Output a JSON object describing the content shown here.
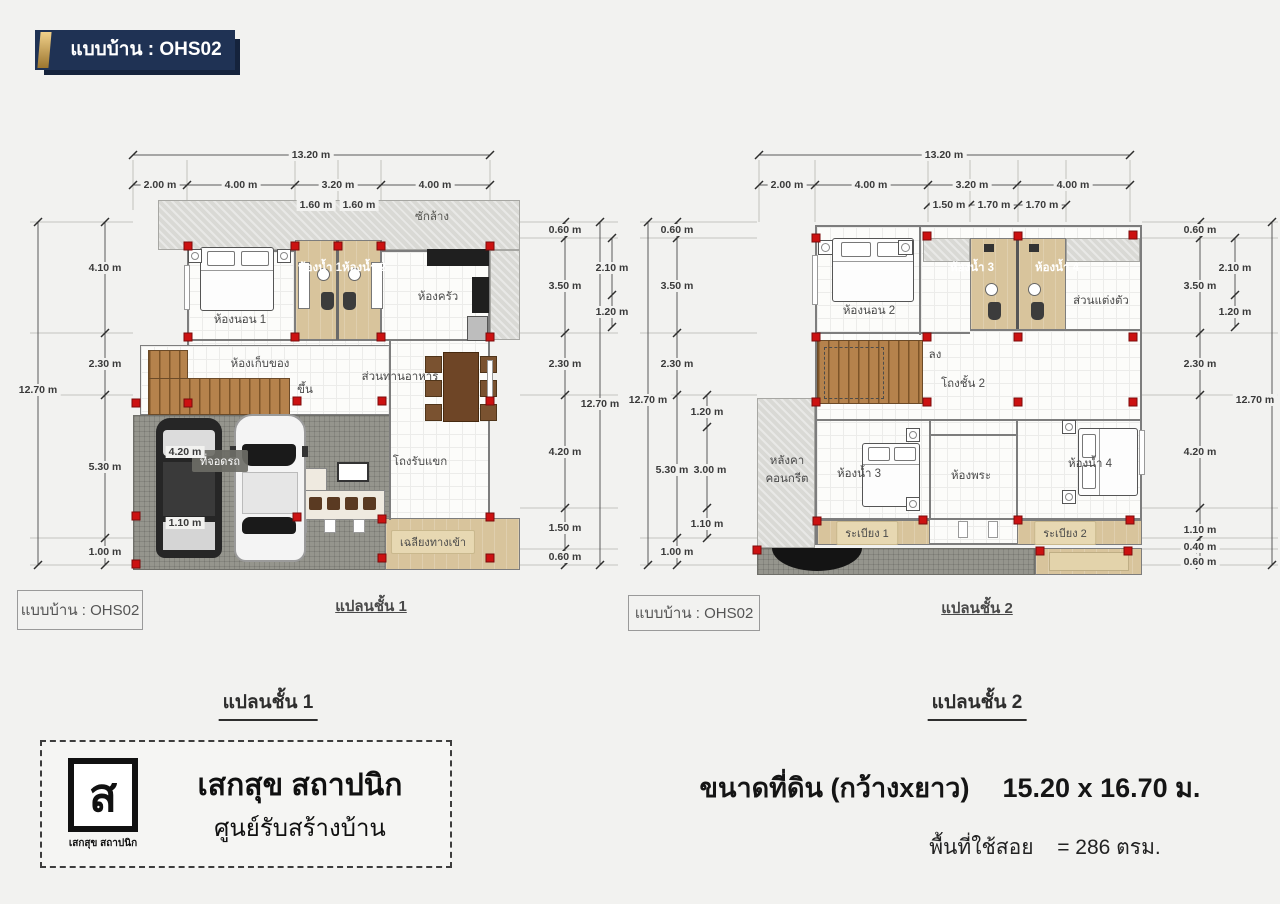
{
  "header": {
    "badge": "แบบบ้าน : OHS02"
  },
  "plan1": {
    "sheet_box": "แบบบ้าน : OHS02",
    "sheet_label": "แปลนชั้น 1",
    "caption": "แปลนชั้น 1",
    "rooms": {
      "laundry": "ซักล้าง",
      "bedroom1": "ห้องนอน 1",
      "bath1": "ห้องน้ำ 1",
      "bath2": "ห้องน้ำ 2",
      "kitchen": "ห้องครัว",
      "storage": "ห้องเก็บของ",
      "stairs_up": "ขึ้น",
      "dining": "ส่วนทานอาหาร",
      "carport": "ที่จอดรถ",
      "living": "โถงรับแขก",
      "porch": "เฉลียงทางเข้า"
    },
    "dims": {
      "top_total": "13.20 m",
      "top": [
        "2.00 m",
        "4.00 m",
        "3.20 m",
        "4.00 m"
      ],
      "top_inner": [
        "1.60 m",
        "1.60 m"
      ],
      "left_total": "12.70 m",
      "left": [
        "4.10 m",
        "2.30 m",
        "5.30 m",
        "1.00 m"
      ],
      "left_inner": [
        "4.20 m",
        "1.10 m"
      ],
      "right": [
        "0.60 m",
        "3.50 m",
        "2.30 m",
        "4.20 m",
        "1.50 m",
        "0.60 m"
      ],
      "right_inner": [
        "2.10 m",
        "1.20 m"
      ],
      "right_total": "12.70 m"
    }
  },
  "plan2": {
    "sheet_box": "แบบบ้าน : OHS02",
    "sheet_label": "แปลนชั้น 2",
    "caption": "แปลนชั้น 2",
    "rooms": {
      "bedroom2": "ห้องนอน 2",
      "bath3": "ห้องน้ำ 3",
      "bath4": "ห้องน้ำ 4",
      "dressing": "ส่วนแต่งตัว",
      "stairs_down": "ลง",
      "hall": "โถงชั้น 2",
      "roof_line1": "หลังคา",
      "roof_line2": "คอนกรีต",
      "bedroom3": "ห้องน้ำ 3",
      "prayer": "ห้องพระ",
      "bedroom4": "ห้องน้ำ 4",
      "balcony1": "ระเบียง 1",
      "balcony2": "ระเบียง 2"
    },
    "dims": {
      "top_total": "13.20 m",
      "top": [
        "2.00 m",
        "4.00 m",
        "3.20 m",
        "4.00 m"
      ],
      "top_inner": [
        "1.50 m",
        "1.70 m",
        "1.70 m"
      ],
      "left_total": "12.70 m",
      "left": [
        "0.60 m",
        "3.50 m",
        "2.30 m",
        "5.30 m",
        "1.00 m"
      ],
      "left_inner": [
        "1.20 m",
        "3.00 m",
        "1.10 m"
      ],
      "right": [
        "0.60 m",
        "3.50 m",
        "2.30 m",
        "4.20 m",
        "1.10 m",
        "0.40 m",
        "0.60 m"
      ],
      "right_inner": [
        "2.10 m",
        "1.20 m"
      ],
      "right_total": "12.70 m"
    }
  },
  "footer": {
    "logo_glyph": "ส",
    "logo_small": "เสกสุข สถาปนิก",
    "company": "เสกสุข สถาปนิก",
    "subtitle": "ศูนย์รับสร้างบ้าน",
    "land_label": "ขนาดที่ดิน (กว้างxยาว)",
    "land_value": "15.20 x 16.70 ม.",
    "area_label": "พื้นที่ใช้สอย",
    "area_value": "= 286 ตรม."
  },
  "colors": {
    "navy": "#1f3254",
    "gold": "#c9a24a",
    "column_red": "#cc1111",
    "tan": "#d8c49c"
  }
}
